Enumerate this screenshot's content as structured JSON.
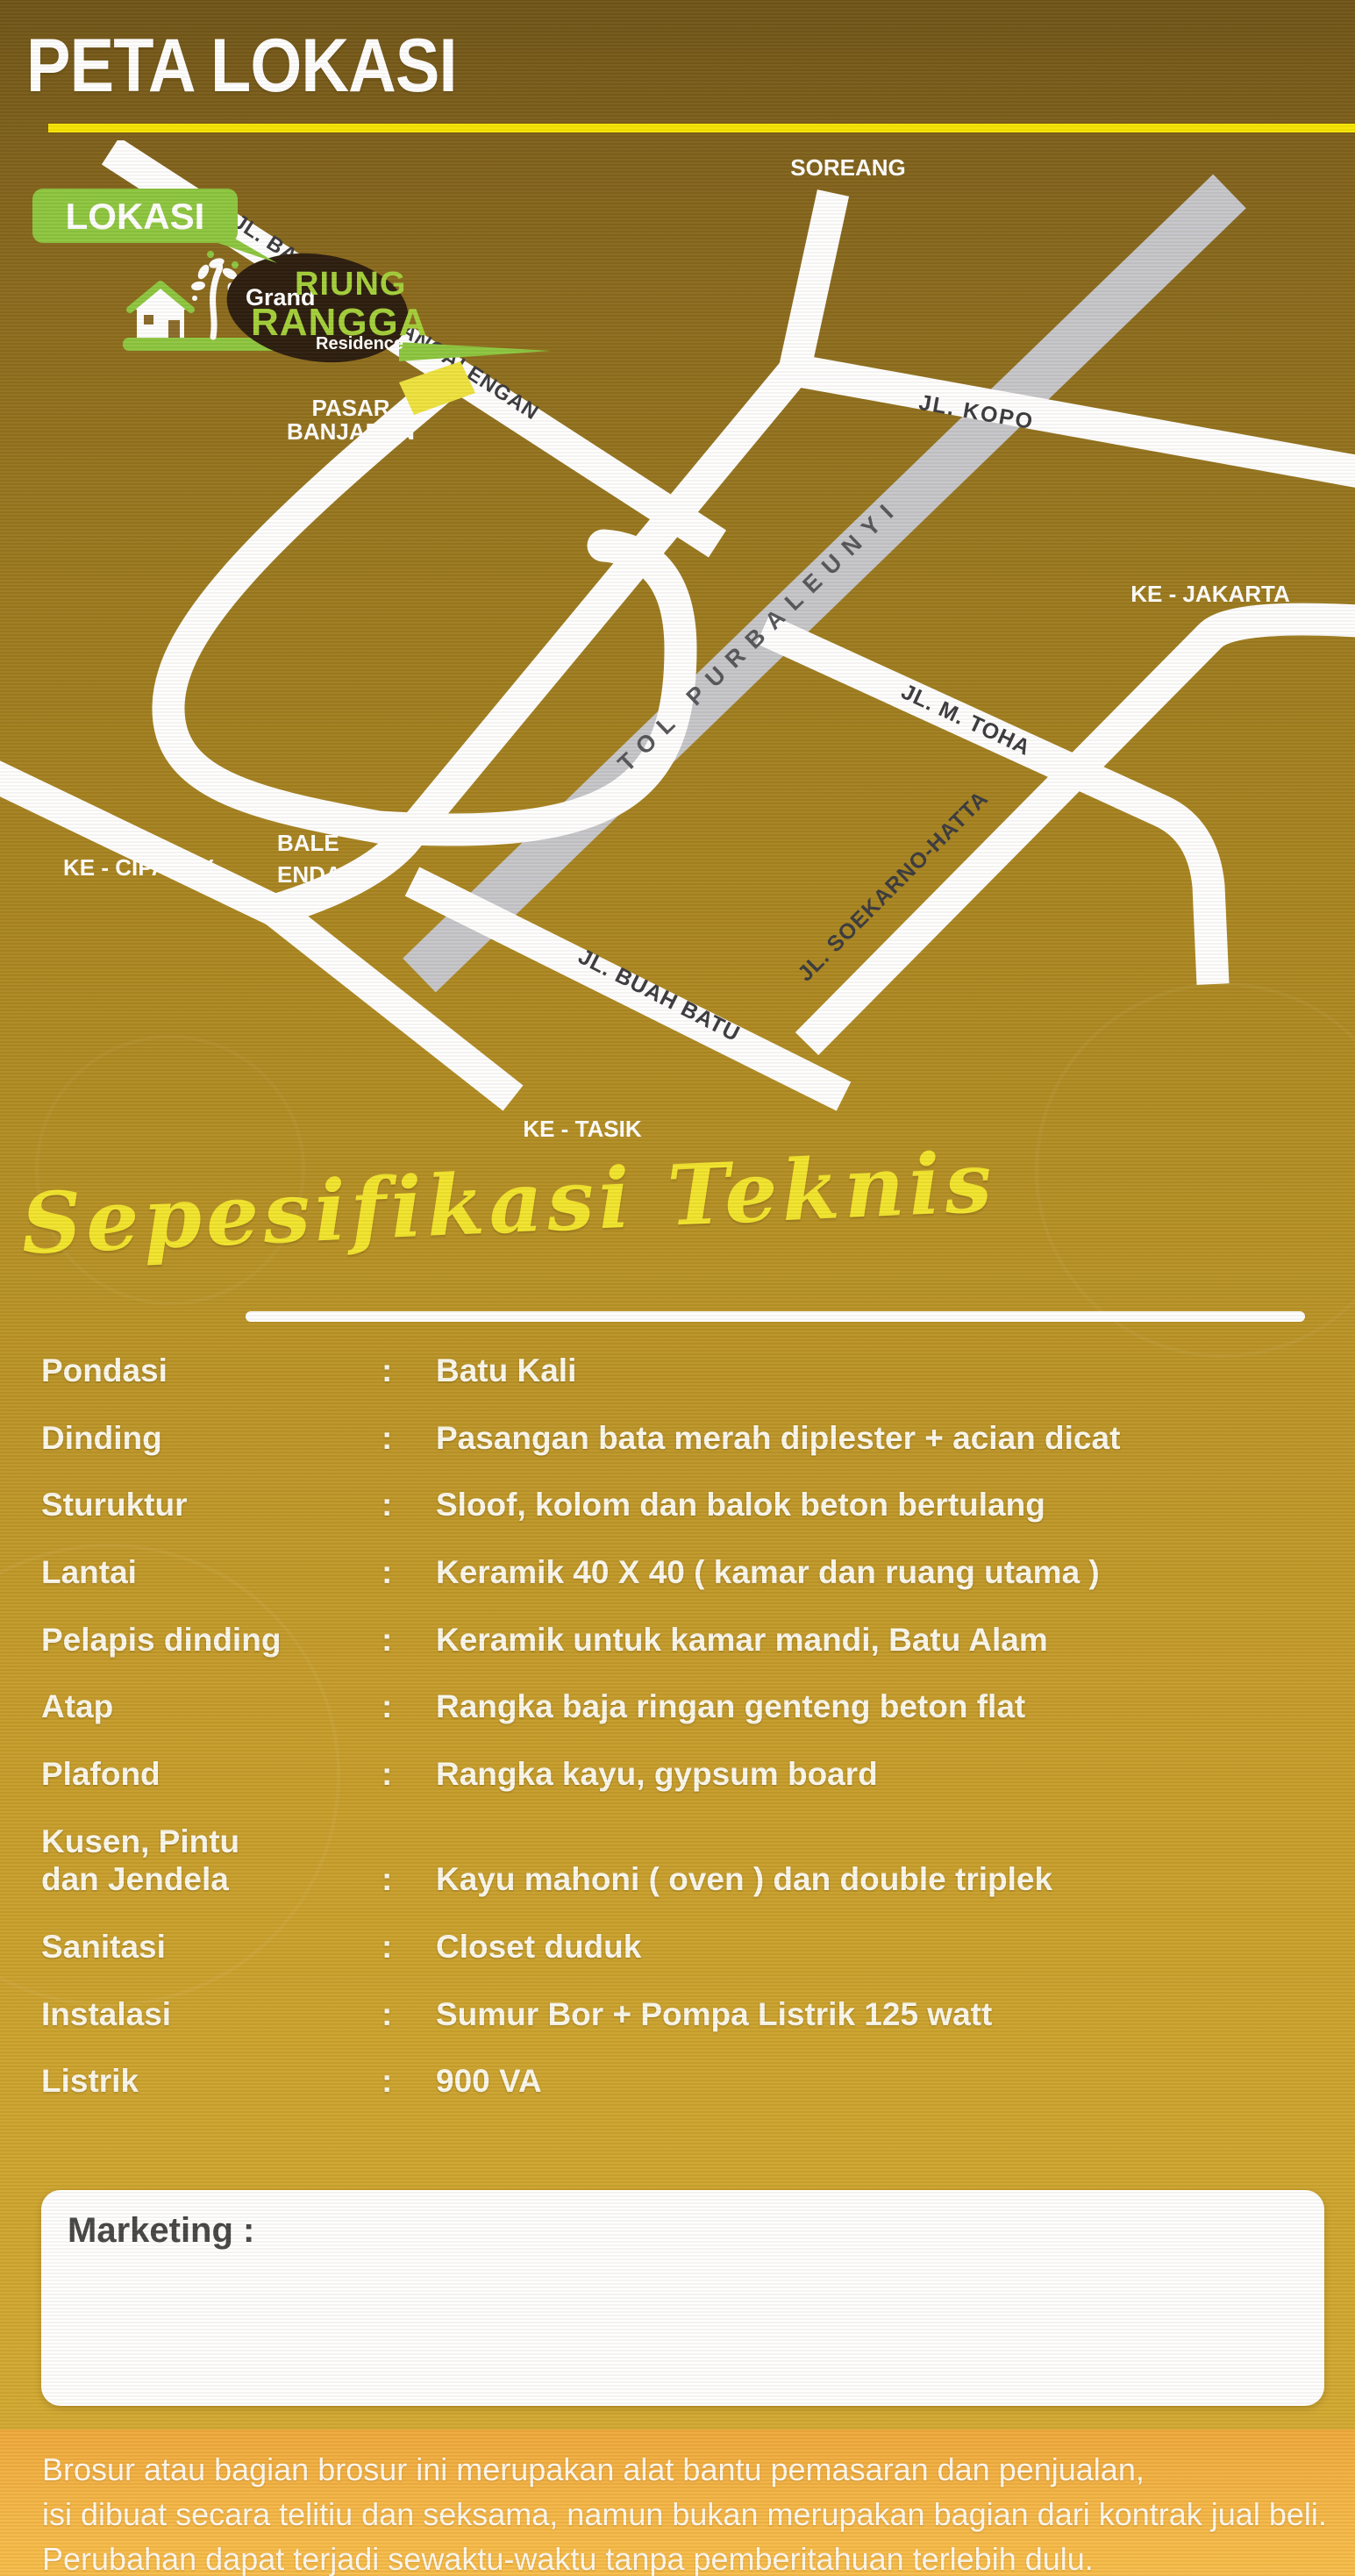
{
  "page": {
    "title": "PETA LOKASI"
  },
  "map": {
    "badge_label": "LOKASI",
    "logo": {
      "grand": "Grand",
      "riung": "RIUNG",
      "rangga": "RANGGA",
      "residence": "Residence"
    },
    "labels": {
      "soreang": "SOREANG",
      "banjaran_road": "JL. BANJARAN - PANGALENGAN",
      "kopo_road": "JL. KOPO",
      "pasar_line1": "PASAR",
      "pasar_line2": "BANJARAN",
      "ke_jakarta": "KE - JAKARTA",
      "tol": "TOL PURBALEUNYI",
      "m_toha_road": "JL. M. TOHA",
      "ke_ciparay": "KE - CIPARAY",
      "bale_line1": "BALE",
      "bale_line2": "ENDAH",
      "buah_batu_road": "JL. BUAH BATU",
      "soekarno_road": "JL. SOEKARNO-HATTA",
      "ke_tasik": "KE - TASIK"
    }
  },
  "specs": {
    "heading": "Sepesifikasi Teknis",
    "colon": ":",
    "rows": [
      {
        "label": "Pondasi",
        "value": "Batu Kali"
      },
      {
        "label": "Dinding",
        "value": "Pasangan bata merah diplester + acian dicat"
      },
      {
        "label": "Sturuktur",
        "value": "Sloof, kolom dan balok beton bertulang"
      },
      {
        "label": "Lantai",
        "value": "Keramik 40 X 40 ( kamar dan ruang utama )"
      },
      {
        "label": "Pelapis dinding",
        "value": "Keramik untuk kamar mandi, Batu Alam"
      },
      {
        "label": "Atap",
        "value": "Rangka baja ringan genteng beton flat"
      },
      {
        "label": "Plafond",
        "value": "Rangka kayu, gypsum board"
      },
      {
        "label": "Kusen, Pintu\ndan Jendela",
        "value": "Kayu mahoni ( oven ) dan double triplek"
      },
      {
        "label": "Sanitasi",
        "value": "Closet duduk"
      },
      {
        "label": "Instalasi",
        "value": "Sumur Bor + Pompa Listrik 125 watt"
      },
      {
        "label": "Listrik",
        "value": "900 VA"
      }
    ]
  },
  "marketing": {
    "label": "Marketing :"
  },
  "disclaimer": {
    "line1": "Brosur atau bagian brosur ini merupakan alat bantu pemasaran dan penjualan,",
    "line2": "isi dibuat secara telitiu dan seksama, namun bukan merupakan bagian dari kontrak jual beli.",
    "line3": "Perubahan dapat terjadi sewaktu-waktu tanpa pemberitahuan terlebih dulu."
  },
  "colors": {
    "accent_yellow": "#f6e400",
    "badge_green": "#8dc63f",
    "logo_green": "#a3cf3a",
    "marker_yellow": "#eee23e",
    "toll_gray": "#c6c6ca",
    "heading_yellow": "#f2e42c",
    "disclaimer_band": "#f2b148"
  }
}
